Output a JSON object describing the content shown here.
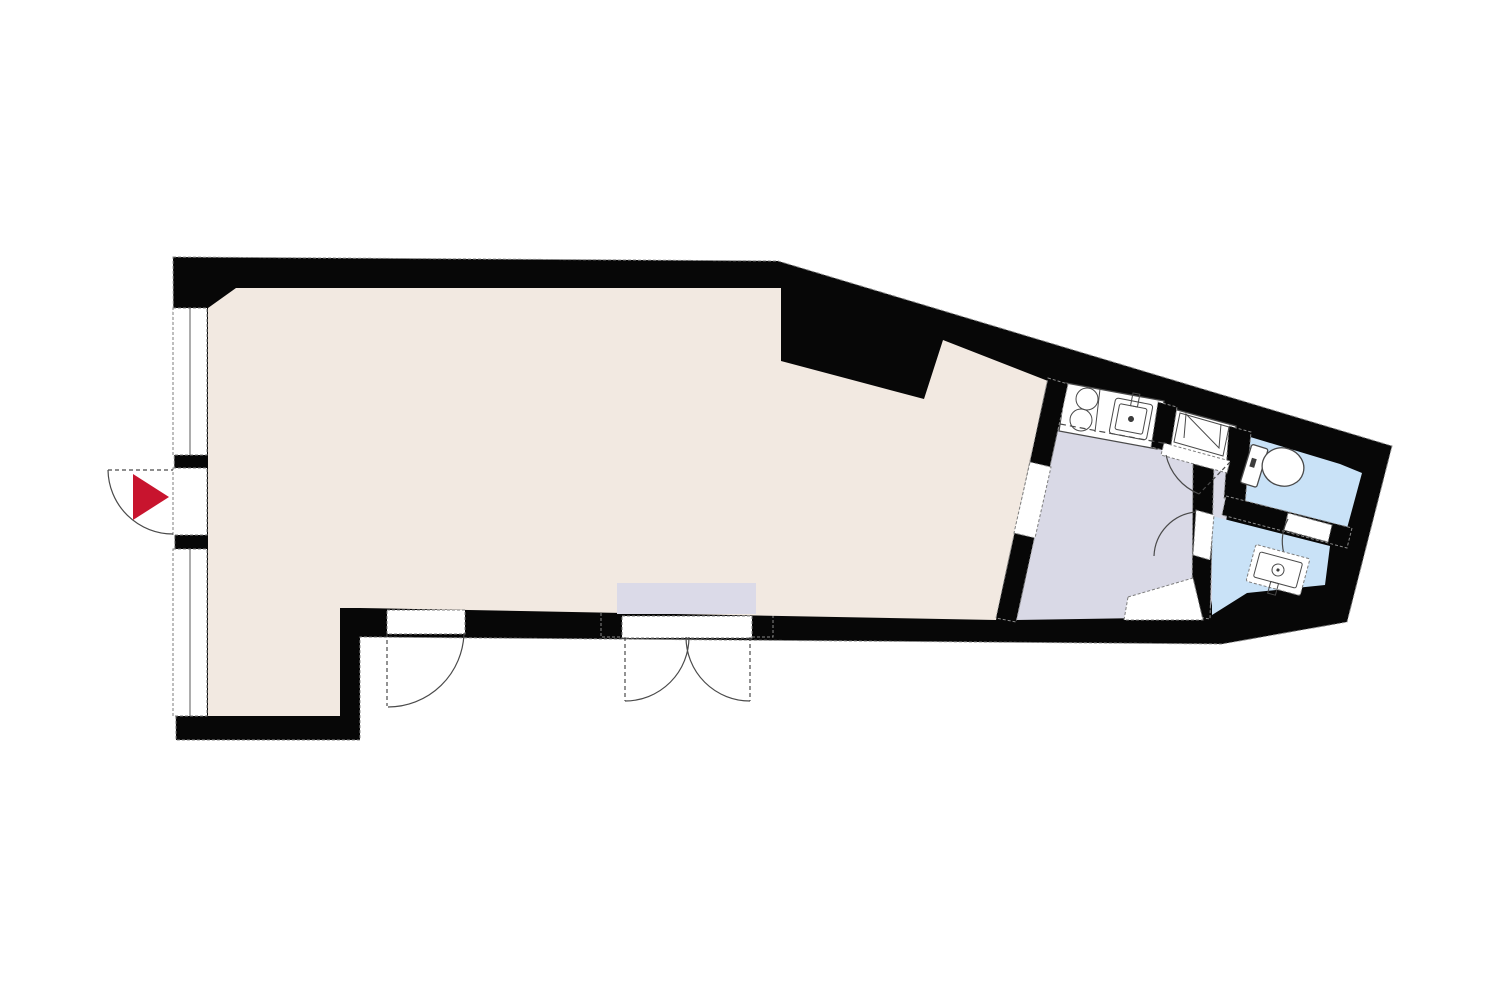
{
  "page": {
    "title": "Apartment floor plan"
  },
  "colors": {
    "background": "#ffffff",
    "wall": "#070707",
    "main_room": "#f2e9e1",
    "hall_kitchen": "#d9d9e6",
    "wet_room": "#c9e2f7",
    "alcove_inset": "#dbdae8",
    "fixture": "#ffffff",
    "entrance_arrow": "#c8142e",
    "line": "#4a4a4a"
  },
  "rooms": [
    {
      "id": "main-room",
      "kind": "living-dining",
      "fill_key": "main_room"
    },
    {
      "id": "kitchen-hall",
      "kind": "kitchen-hallway",
      "fill_key": "hall_kitchen"
    },
    {
      "id": "toilet-room",
      "kind": "wc",
      "fill_key": "wet_room"
    },
    {
      "id": "washbasin-room",
      "kind": "washroom",
      "fill_key": "wet_room"
    },
    {
      "id": "entry-alcove",
      "kind": "recessed-double-door-niche",
      "fill_key": "alcove_inset"
    }
  ],
  "fixtures": [
    "kitchen-counter",
    "stove-burner",
    "stove-burner",
    "kitchen-sink",
    "faucet",
    "washing-machine",
    "toilet",
    "washbasin",
    "storage-step"
  ],
  "doors": [
    "entrance-door",
    "balcony-single-door",
    "balcony-double-door",
    "main-to-hall-opening",
    "toilet-door",
    "washbasin-door",
    "connecting-door"
  ],
  "windows": [
    "window-left-upper",
    "window-left-lower"
  ],
  "markers": {
    "entrance": "red-arrow-pointing-right"
  }
}
